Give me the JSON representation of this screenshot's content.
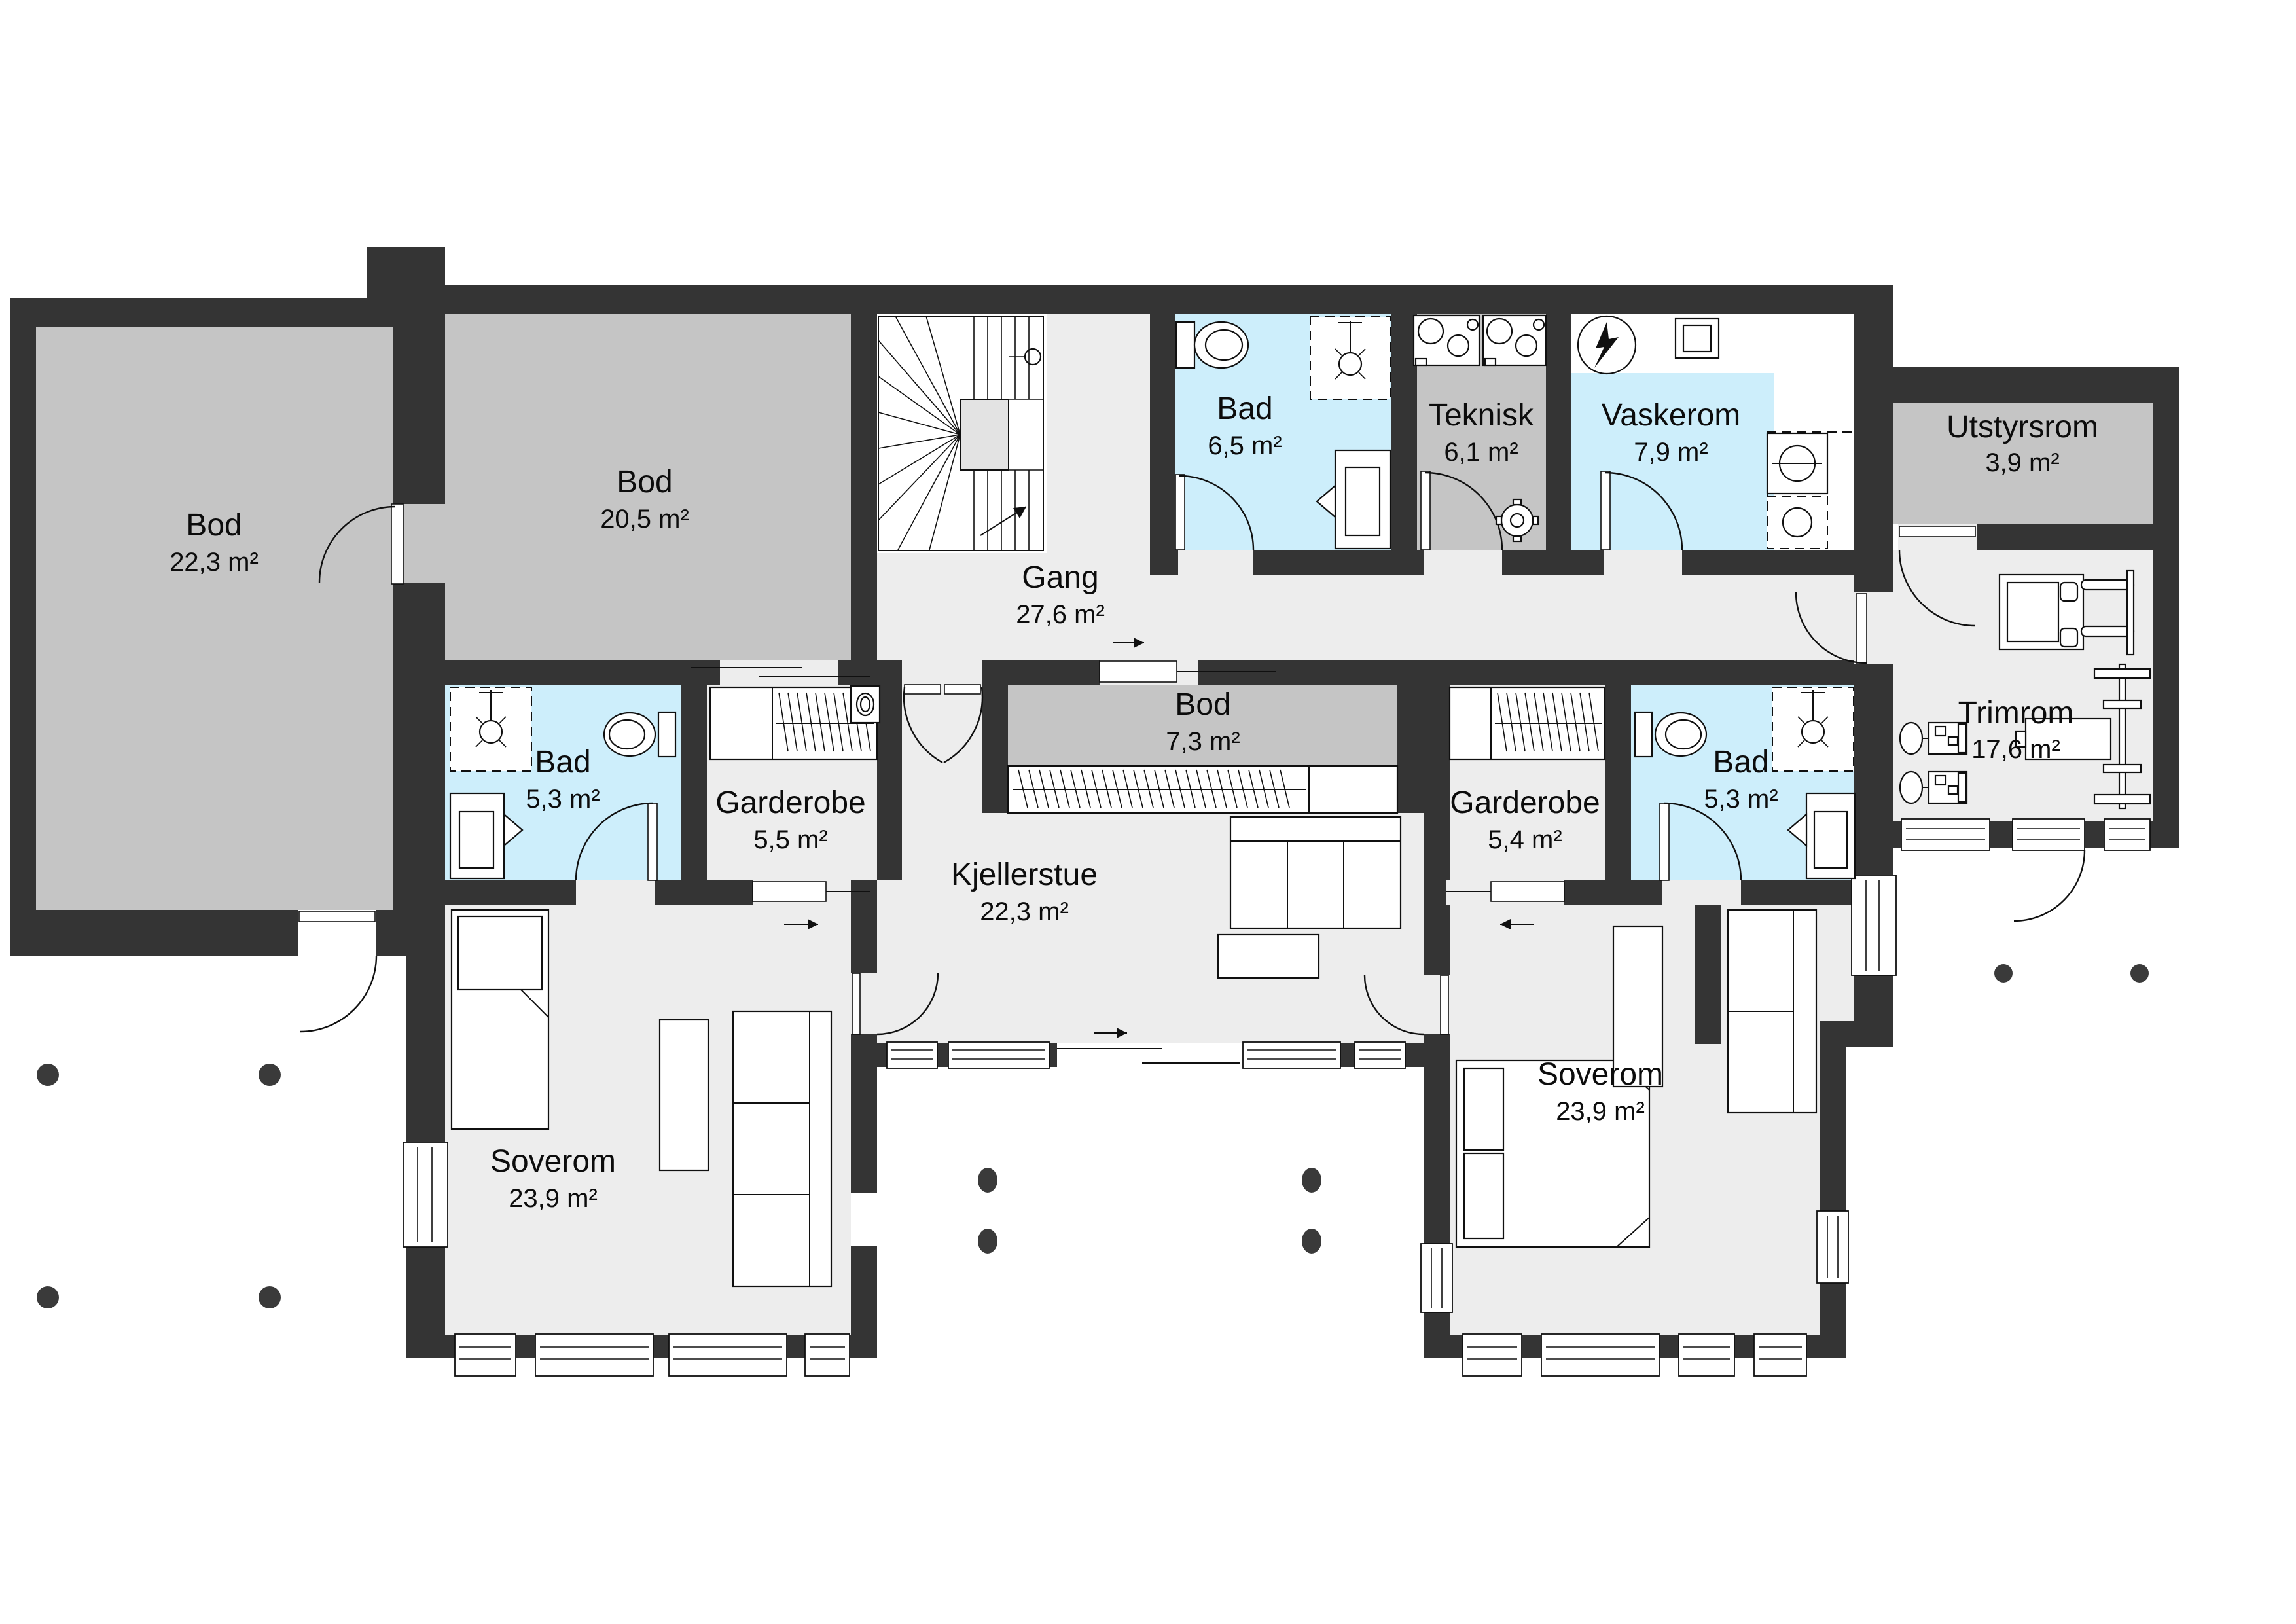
{
  "plan_type": "floor-plan",
  "language": "Norwegian",
  "colors": {
    "wall": "#343434",
    "floor_light": "#ededed",
    "floor_storage_gray": "#c5c5c5",
    "wet_room_blue": "#cdeefb",
    "outside": "#ffffff",
    "column_dot": "#3a3a3a",
    "text": "#0c0c0c"
  },
  "rooms": [
    {
      "id": "bod-left",
      "name": "Bod",
      "area": "22,3 m²"
    },
    {
      "id": "bod-20",
      "name": "Bod",
      "area": "20,5 m²"
    },
    {
      "id": "gang",
      "name": "Gang",
      "area": "27,6 m²"
    },
    {
      "id": "bad-6-5",
      "name": "Bad",
      "area": "6,5 m²"
    },
    {
      "id": "teknisk",
      "name": "Teknisk",
      "area": "6,1 m²"
    },
    {
      "id": "vaskerom",
      "name": "Vaskerom",
      "area": "7,9 m²"
    },
    {
      "id": "utstyrsrom",
      "name": "Utstyrsrom",
      "area": "3,9 m²"
    },
    {
      "id": "trimrom",
      "name": "Trimrom",
      "area": "17,6 m²"
    },
    {
      "id": "bad-left",
      "name": "Bad",
      "area": "5,3 m²"
    },
    {
      "id": "garderobe-left",
      "name": "Garderobe",
      "area": "5,5 m²"
    },
    {
      "id": "bod-7",
      "name": "Bod",
      "area": "7,3 m²"
    },
    {
      "id": "garderobe-right",
      "name": "Garderobe",
      "area": "5,4 m²"
    },
    {
      "id": "bad-right",
      "name": "Bad",
      "area": "5,3 m²"
    },
    {
      "id": "kjellerstue",
      "name": "Kjellerstue",
      "area": "22,3 m²"
    },
    {
      "id": "soverom-left",
      "name": "Soverom",
      "area": "23,9 m²"
    },
    {
      "id": "soverom-right",
      "name": "Soverom",
      "area": "23,9 m²"
    }
  ]
}
